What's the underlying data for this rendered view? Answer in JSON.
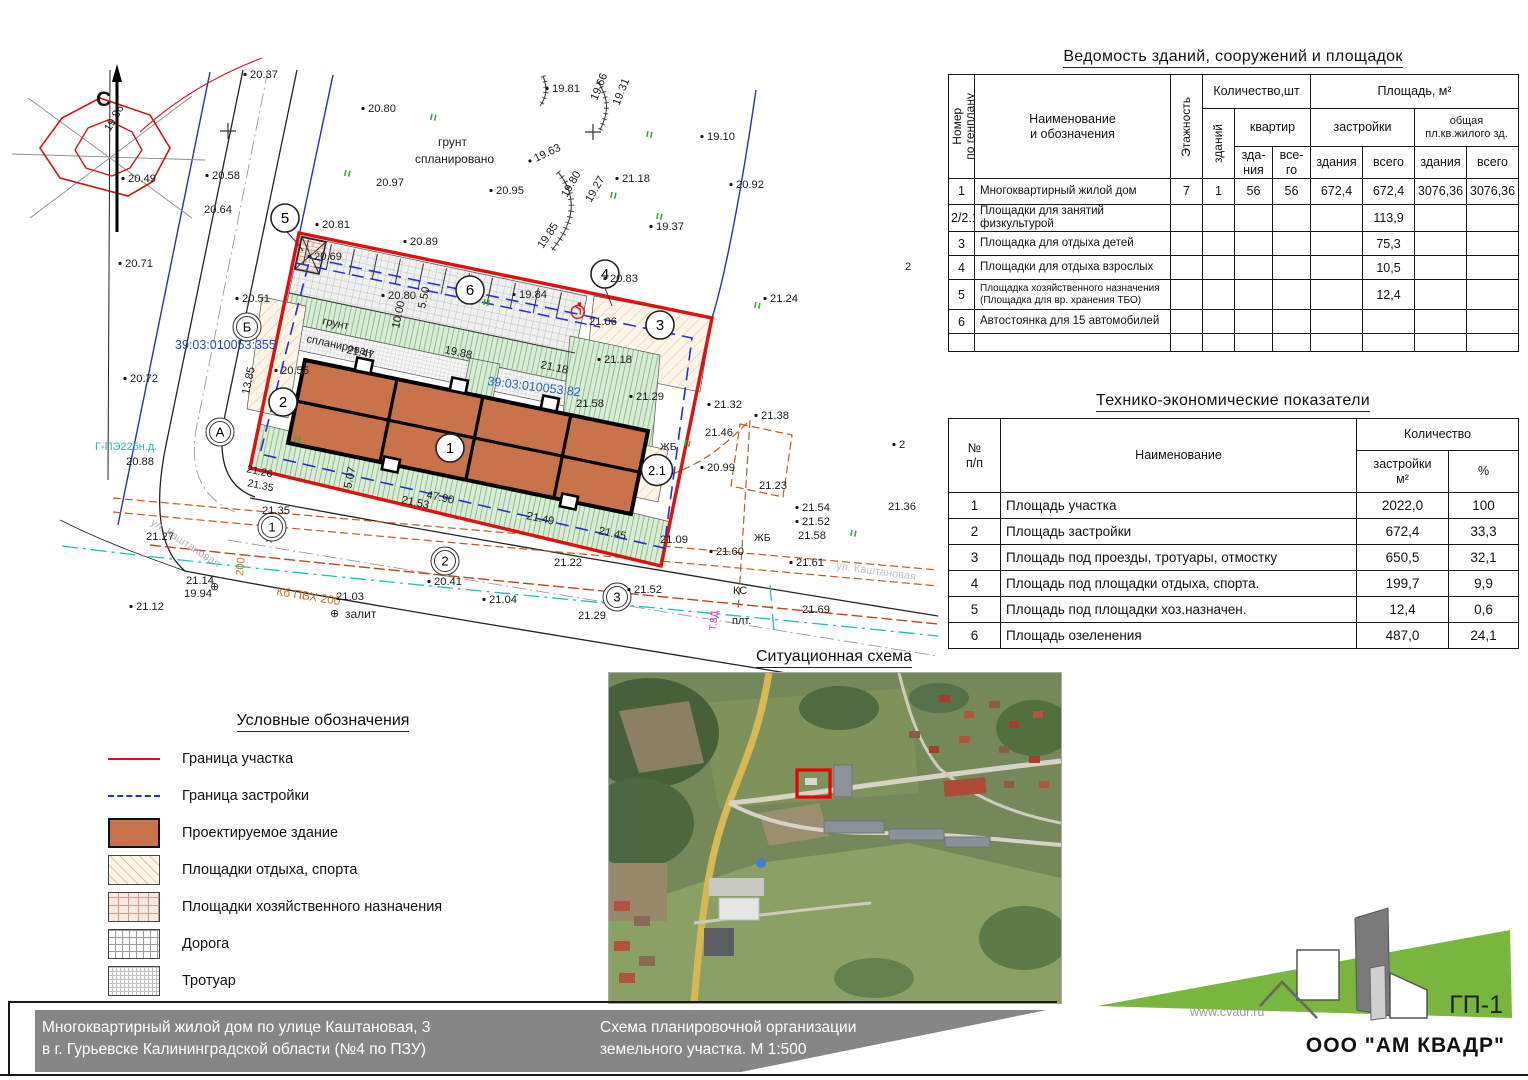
{
  "sheet": {
    "code": "ГП-1"
  },
  "tables": {
    "vedomost": {
      "title": "Ведомость зданий, сооружений и площадок",
      "headers": {
        "num": "Номер\nпо генплану",
        "name": "Наименование\nи обозначения",
        "floors": "Этажность",
        "qty": "Количество,шт",
        "buildings": "зданий",
        "apartments": "квартир",
        "area": "Площадь, м²",
        "zastroyki": "застройки",
        "obshchaya": "общая\nпл.кв.жилого зд.",
        "sub": [
          "зда-\nния",
          "все-\nго",
          "здания",
          "всего",
          "здания",
          "всего"
        ]
      },
      "rows": [
        [
          "1",
          "Многоквартирный  жилой дом",
          "7",
          "1",
          "56",
          "56",
          "672,4",
          "672,4",
          "3076,36",
          "3076,36"
        ],
        [
          "2/2.1",
          "Площадки для занятий физкультурой",
          "",
          "",
          "",
          "",
          "",
          "113,9",
          "",
          ""
        ],
        [
          "3",
          "Площадка для отдыха детей",
          "",
          "",
          "",
          "",
          "",
          "75,3",
          "",
          ""
        ],
        [
          "4",
          "Площадки для отдыха взрослых",
          "",
          "",
          "",
          "",
          "",
          "10,5",
          "",
          ""
        ],
        [
          "5",
          "Площадка хозяйственного назначения\n(Площадка для вр. хранения ТБО)",
          "",
          "",
          "",
          "",
          "",
          "12,4",
          "",
          ""
        ],
        [
          "6",
          "Автостоянка для 15 автомобилей",
          "",
          "",
          "",
          "",
          "",
          "",
          "",
          ""
        ],
        [
          "",
          "",
          "",
          "",
          "",
          "",
          "",
          "",
          "",
          ""
        ]
      ]
    },
    "tep": {
      "title": "Технико-экономические показатели",
      "headers": {
        "num": "№\nп/п",
        "name": "Наименование",
        "qty": "Количество",
        "sub": [
          "застройки\nм²",
          "%"
        ]
      },
      "rows": [
        [
          "1",
          "Площадь участка",
          "2022,0",
          "100"
        ],
        [
          "2",
          "Площадь застройки",
          "672,4",
          "33,3"
        ],
        [
          "3",
          "Площадь под проезды, тротуары, отмостку",
          "650,5",
          "32,1"
        ],
        [
          "4",
          "Площадь под площадки отдыха, спорта.",
          "199,7",
          "9,9"
        ],
        [
          "5",
          "Площадь под площадки хоз.назначен.",
          "12,4",
          "0,6"
        ],
        [
          "6",
          "Площадь озеленения",
          "487,0",
          "24,1"
        ]
      ]
    }
  },
  "legend": {
    "title": "Условные обозначения",
    "items": [
      {
        "swatch": "line-red",
        "label": "Граница участка"
      },
      {
        "swatch": "line-blue-dash",
        "label": "Граница застройки"
      },
      {
        "swatch": "fill-building",
        "label": "Проектируемое здание"
      },
      {
        "swatch": "hatch-rest",
        "label": "Площадки отдыха, спорта"
      },
      {
        "swatch": "hatch-household",
        "label": "Площадки хозяйственного назначения"
      },
      {
        "swatch": "hatch-road",
        "label": "Дорога"
      },
      {
        "swatch": "hatch-sidewalk",
        "label": "Тротуар"
      }
    ]
  },
  "scheme": {
    "title": "Ситуационная схема"
  },
  "footer": {
    "left1": "Многоквартирный жилой дом по улице Каштановая, 3",
    "left2": "в г. Гурьевске Калининградской области (№4 по ПЗУ)",
    "mid1": "Схема планировочной организации",
    "mid2": "земельного участка. М 1:500"
  },
  "logo": {
    "site": "www.cvadr.ru",
    "sheet": "ГП-1",
    "company": "ООО \"АМ КВАДР\""
  },
  "colors": {
    "boundary_red": "#dd1111",
    "build_line_blue": "#2233bb",
    "building_fill": "#c8734a",
    "cadastral_blue": "#2244cc",
    "utility_cyan": "#18b7b7",
    "utility_orange": "#c07820",
    "logo_green": "#79b63d",
    "footer_gray": "#868686"
  },
  "plan": {
    "marks": [
      {
        "t": "20.37",
        "x": 250,
        "y": 78
      },
      {
        "t": "20.80",
        "x": 368,
        "y": 112
      },
      {
        "t": "19.81",
        "x": 552,
        "y": 92
      },
      {
        "t": "19.66",
        "x": 597,
        "y": 101,
        "r": -68,
        "dot": false
      },
      {
        "t": "19.31",
        "x": 619,
        "y": 106,
        "r": -68,
        "dot": false
      },
      {
        "t": "19.10",
        "x": 707,
        "y": 140
      },
      {
        "t": "19.86",
        "x": 110,
        "y": 132,
        "r": -60,
        "dot": false
      },
      {
        "t": "20.49",
        "x": 128,
        "y": 182
      },
      {
        "t": "20.58",
        "x": 212,
        "y": 179
      },
      {
        "t": "20.64",
        "x": 204,
        "y": 213,
        "dot": false
      },
      {
        "t": "20.97",
        "x": 376,
        "y": 186,
        "dot": false
      },
      {
        "t": "20.95",
        "x": 496,
        "y": 194
      },
      {
        "t": "19.63",
        "x": 536,
        "y": 162,
        "r": -25
      },
      {
        "t": "21.18",
        "x": 622,
        "y": 182
      },
      {
        "t": "20.92",
        "x": 736,
        "y": 188
      },
      {
        "t": "19.80",
        "x": 567,
        "y": 198,
        "r": -60,
        "dot": false
      },
      {
        "t": "19.27",
        "x": 591,
        "y": 203,
        "r": -60,
        "dot": false
      },
      {
        "t": "19.85",
        "x": 543,
        "y": 249,
        "r": -56,
        "dot": false
      },
      {
        "t": "19.37",
        "x": 656,
        "y": 230
      },
      {
        "t": "20.81",
        "x": 322,
        "y": 228
      },
      {
        "t": "20.71",
        "x": 125,
        "y": 267
      },
      {
        "t": "20.89",
        "x": 410,
        "y": 245
      },
      {
        "t": "20.69",
        "x": 314,
        "y": 260
      },
      {
        "t": "20.51",
        "x": 242,
        "y": 302
      },
      {
        "t": "20.80",
        "x": 388,
        "y": 299
      },
      {
        "t": "19.84",
        "x": 519,
        "y": 298
      },
      {
        "t": "20.83",
        "x": 610,
        "y": 282
      },
      {
        "t": "21.06",
        "x": 589,
        "y": 325,
        "dot": false
      },
      {
        "t": "21.24",
        "x": 770,
        "y": 302
      },
      {
        "t": "20.55",
        "x": 281,
        "y": 374
      },
      {
        "t": "20.72",
        "x": 130,
        "y": 382
      },
      {
        "t": "грунт",
        "x": 438,
        "y": 146,
        "dot": false,
        "fs": 12
      },
      {
        "t": "спланировано",
        "x": 415,
        "y": 163,
        "dot": false,
        "fs": 12
      },
      {
        "t": "грунт",
        "x": 322,
        "y": 324,
        "r": 12,
        "dot": false,
        "fs": 11
      },
      {
        "t": "спланирован",
        "x": 306,
        "y": 342,
        "r": 12,
        "dot": false,
        "fs": 11
      },
      {
        "t": "21.47",
        "x": 346,
        "y": 353,
        "r": 12,
        "dot": false
      },
      {
        "t": "19.88",
        "x": 444,
        "y": 353,
        "r": 12,
        "dot": false
      },
      {
        "t": "21.18",
        "x": 540,
        "y": 368,
        "r": 12,
        "dot": false
      },
      {
        "t": "21.18",
        "x": 604,
        "y": 363
      },
      {
        "t": "39:03:010053:355",
        "x": 175,
        "y": 349,
        "dot": false,
        "c": "#2244cc",
        "fs": 12.5
      },
      {
        "t": "39:03:010053:82",
        "x": 487,
        "y": 385,
        "r": 7,
        "dot": false,
        "c": "#2563c9",
        "fs": 12.5
      },
      {
        "t": "21.58",
        "x": 576,
        "y": 407,
        "dot": false
      },
      {
        "t": "21.29",
        "x": 636,
        "y": 400
      },
      {
        "t": "21.32",
        "x": 714,
        "y": 408
      },
      {
        "t": "21.38",
        "x": 761,
        "y": 419
      },
      {
        "t": "21.46",
        "x": 705,
        "y": 436,
        "dot": false
      },
      {
        "t": "20.99",
        "x": 707,
        "y": 471
      },
      {
        "t": "21.23",
        "x": 759,
        "y": 489,
        "dot": false
      },
      {
        "t": "ЖБ",
        "x": 660,
        "y": 450,
        "dot": false,
        "fs": 10.5
      },
      {
        "t": "2",
        "x": 905,
        "y": 270,
        "dot": false
      },
      {
        "t": "2",
        "x": 899,
        "y": 448
      },
      {
        "t": "21.26",
        "x": 246,
        "y": 472,
        "r": 12,
        "dot": false,
        "fs": 10.5
      },
      {
        "t": "21.35",
        "x": 247,
        "y": 486,
        "r": 12,
        "dot": false,
        "fs": 10.5
      },
      {
        "t": "20.88",
        "x": 126,
        "y": 465,
        "dot": false
      },
      {
        "t": "Г-ПЭ225н.д.",
        "x": 95,
        "y": 450,
        "dot": false,
        "c": "#18b7b7",
        "fs": 11
      },
      {
        "t": "13.85",
        "x": 249,
        "y": 395,
        "r": -78,
        "dot": false
      },
      {
        "t": "5.07",
        "x": 351,
        "y": 489,
        "r": -78,
        "dot": false
      },
      {
        "t": "5.50",
        "x": 425,
        "y": 309,
        "r": -78,
        "dot": false
      },
      {
        "t": "10.00",
        "x": 399,
        "y": 329,
        "r": -78,
        "dot": false
      },
      {
        "t": "47.90",
        "x": 426,
        "y": 498,
        "r": 12,
        "dot": false
      },
      {
        "t": "21.53",
        "x": 401,
        "y": 503,
        "r": 12,
        "dot": false
      },
      {
        "t": "21.49",
        "x": 526,
        "y": 519,
        "r": 12,
        "dot": false
      },
      {
        "t": "21.45",
        "x": 598,
        "y": 534,
        "r": 12,
        "dot": false
      },
      {
        "t": "21.09",
        "x": 660,
        "y": 543,
        "dot": false
      },
      {
        "t": "ул. Каштановая",
        "x": 150,
        "y": 524,
        "r": 33,
        "dot": false,
        "c": "#b3b3b3",
        "fs": 11
      },
      {
        "t": "ул. Каштановая",
        "x": 836,
        "y": 569,
        "r": 8,
        "dot": false,
        "c": "#c0c0c0",
        "fs": 11
      },
      {
        "t": "21.27",
        "x": 146,
        "y": 540,
        "dot": false
      },
      {
        "t": "21.35",
        "x": 262,
        "y": 514,
        "dot": false
      },
      {
        "t": "21.12",
        "x": 136,
        "y": 610
      },
      {
        "t": "21.14",
        "x": 186,
        "y": 584,
        "dot": false
      },
      {
        "t": "19.94",
        "x": 184,
        "y": 597,
        "dot": false
      },
      {
        "t": "200",
        "x": 243,
        "y": 576,
        "r": -85,
        "dot": false,
        "c": "#c07820",
        "fs": 11
      },
      {
        "t": "Кб ПВХ 200",
        "x": 276,
        "y": 595,
        "r": 9,
        "dot": false,
        "c": "#c07820",
        "fs": 12
      },
      {
        "t": "⊕",
        "x": 210,
        "y": 590,
        "dot": false,
        "fs": 11
      },
      {
        "t": "⊕",
        "x": 330,
        "y": 617,
        "dot": false,
        "fs": 11
      },
      {
        "t": "залит",
        "x": 345,
        "y": 618,
        "dot": false,
        "fs": 12
      },
      {
        "t": "21.03",
        "x": 336,
        "y": 600,
        "dot": false
      },
      {
        "t": "20.41",
        "x": 434,
        "y": 585
      },
      {
        "t": "21.04",
        "x": 489,
        "y": 603
      },
      {
        "t": "21.22",
        "x": 554,
        "y": 566,
        "dot": false
      },
      {
        "t": "21.29",
        "x": 578,
        "y": 619,
        "dot": false
      },
      {
        "t": "21.52",
        "x": 634,
        "y": 593
      },
      {
        "t": "21.60",
        "x": 716,
        "y": 555
      },
      {
        "t": "21.61",
        "x": 796,
        "y": 566
      },
      {
        "t": "21.54",
        "x": 802,
        "y": 511
      },
      {
        "t": "21.52",
        "x": 802,
        "y": 525
      },
      {
        "t": "21.58",
        "x": 798,
        "y": 539,
        "dot": false
      },
      {
        "t": "21.36",
        "x": 888,
        "y": 510,
        "dot": false
      },
      {
        "t": "КС",
        "x": 733,
        "y": 594,
        "dot": false,
        "fs": 11
      },
      {
        "t": "ЖБ",
        "x": 754,
        "y": 541,
        "dot": false,
        "fs": 10.5
      },
      {
        "t": "плт.",
        "x": 732,
        "y": 624,
        "dot": false,
        "fs": 11
      },
      {
        "t": "21.69",
        "x": 802,
        "y": 613,
        "dot": false
      },
      {
        "t": "Т.8Д",
        "x": 716,
        "y": 631,
        "r": -85,
        "dot": false,
        "c": "#cc33bb",
        "fs": 10
      },
      {
        "t": "С",
        "x": 96,
        "y": 106,
        "dot": false,
        "fs": 21,
        "b": true
      }
    ],
    "grass": [
      [
        432,
        114
      ],
      [
        648,
        131
      ],
      [
        346,
        170
      ],
      [
        612,
        192
      ],
      [
        658,
        213
      ],
      [
        485,
        299
      ],
      [
        756,
        302
      ],
      [
        296,
        436
      ],
      [
        686,
        440
      ],
      [
        852,
        530
      ],
      [
        268,
        536
      ]
    ],
    "axis_circles": [
      {
        "l": "Б",
        "x": 247,
        "y": 327
      },
      {
        "l": "А",
        "x": 220,
        "y": 432
      },
      {
        "l": "1",
        "x": 272,
        "y": 527
      },
      {
        "l": "2",
        "x": 445,
        "y": 561
      },
      {
        "l": "3",
        "x": 617,
        "y": 597
      }
    ],
    "site_circles": [
      {
        "l": "5",
        "x": 285,
        "y": 218
      },
      {
        "l": "6",
        "x": 470,
        "y": 290
      },
      {
        "l": "4",
        "x": 605,
        "y": 274
      },
      {
        "l": "3",
        "x": 660,
        "y": 325
      },
      {
        "l": "2",
        "x": 283,
        "y": 402
      },
      {
        "l": "1",
        "x": 450,
        "y": 448
      },
      {
        "l": "2.1",
        "x": 657,
        "y": 470
      }
    ]
  }
}
